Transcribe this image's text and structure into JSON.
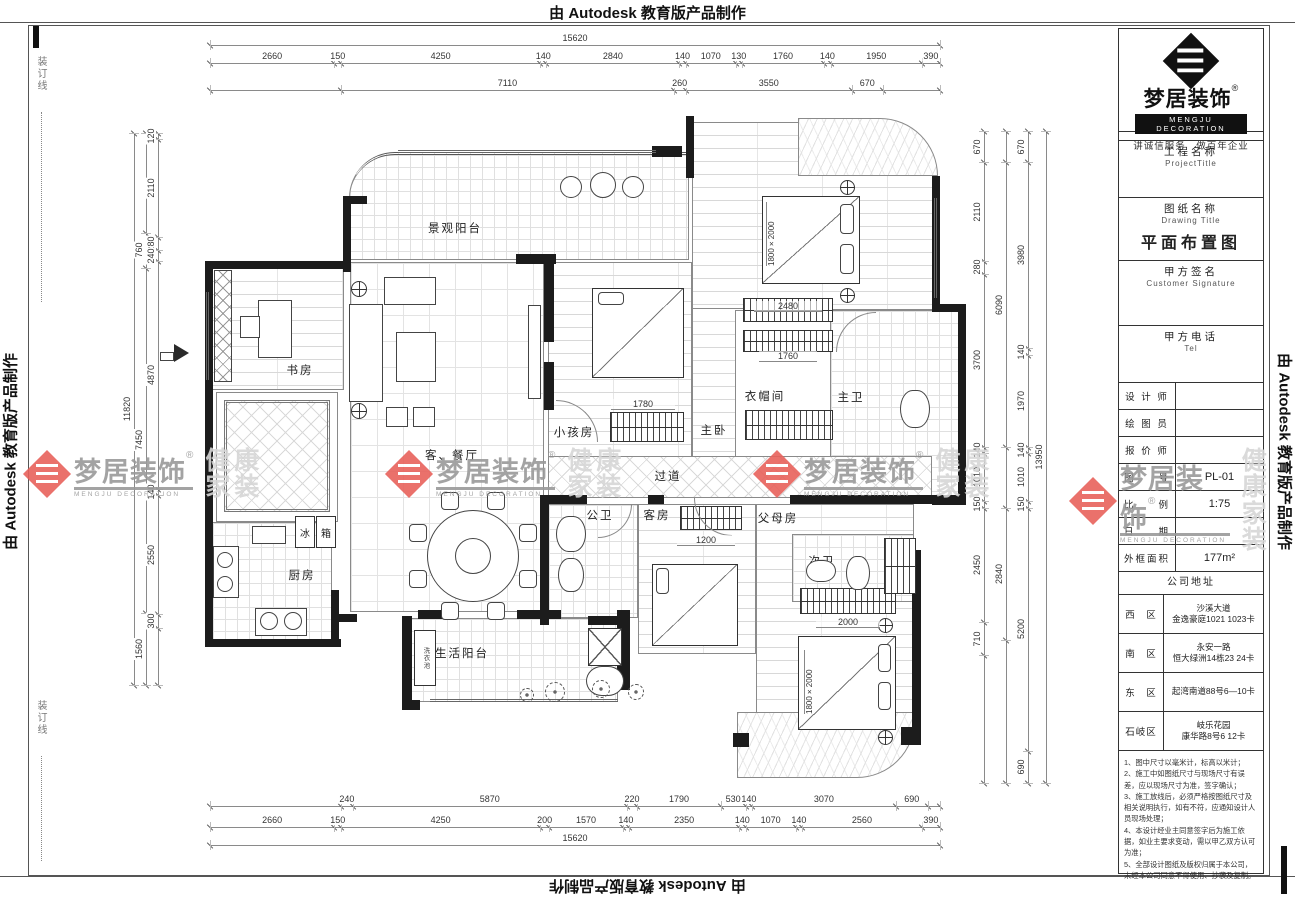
{
  "banners": {
    "top": "由 Autodesk 教育版产品制作",
    "bottom": "由 Autodesk 教育版产品制作",
    "left": "由 Autodesk 教育版产品制作",
    "right": "由 Autodesk 教育版产品制作",
    "binding_line": "装订线"
  },
  "watermark": {
    "brand": "梦居装饰",
    "reg": "®",
    "sub": "MENGJU DECORATION",
    "tag": "健康家装",
    "red": "#e8625c",
    "grey": "#9a9a9a",
    "light": "#d6d6d6"
  },
  "title_block": {
    "logo": {
      "brand": "梦居装饰",
      "reg": "®",
      "sub": "MENGJU DECORATION",
      "slogan": "讲诚信服务　做百年企业"
    },
    "fields": [
      {
        "label": "工程名称",
        "sub": "ProjectTitle",
        "value": ""
      },
      {
        "label": "图纸名称",
        "sub": "Drawing Title",
        "value": "平面布置图"
      },
      {
        "label": "甲方签名",
        "sub": "Customer Signature",
        "value": ""
      },
      {
        "label": "甲方电话",
        "sub": "Tel",
        "value": ""
      }
    ],
    "rows": [
      {
        "label": "设 计 师",
        "value": ""
      },
      {
        "label": "绘 图 员",
        "value": ""
      },
      {
        "label": "报 价 师",
        "value": ""
      },
      {
        "label": "图　　号",
        "value": "PL-01"
      },
      {
        "label": "比　　例",
        "value": "1:75"
      },
      {
        "label": "日　　期",
        "value": ""
      },
      {
        "label": "外框面积",
        "value": "177m²"
      }
    ],
    "address_header": "公司地址",
    "addresses": [
      {
        "area": "西　区",
        "lines": [
          "沙溪大道",
          "金逸豪庭1021 1023卡"
        ]
      },
      {
        "area": "南　区",
        "lines": [
          "永安一路",
          "恒大绿洲14栋23 24卡"
        ]
      },
      {
        "area": "东　区",
        "lines": [
          "起湾南道88号6—10卡",
          ""
        ]
      },
      {
        "area": "石岐区",
        "lines": [
          "岐乐花园",
          "康华路8号6 12卡"
        ]
      }
    ],
    "notes": [
      "1、图中尺寸以毫米计，标高以米计；",
      "2、施工中如图纸尺寸与现场尺寸有误差，应以现场尺寸为准，签字确认；",
      "3、施工放线后，必须严格按图纸尺寸及相关说明执行，如有不符，应通知设计人员现场处理；",
      "4、本设计经业主同意签字后为施工依据，如业主要求变动，需以甲乙双方认可为准；",
      "5、全部设计图纸及版权归属于本公司，未经本公司同意不得使用、抄袭及复制。"
    ]
  },
  "plan": {
    "rooms": {
      "balcony_top": "景观阳台",
      "study": "书房",
      "foyer": "入户玄关",
      "living": "客、餐厅",
      "child": "小孩房",
      "master": "主卧",
      "cloak": "衣帽间",
      "mbath": "主卫",
      "corridor": "过道",
      "pbath": "公卫",
      "guest": "客房",
      "parents": "父母房",
      "sbath": "次卫",
      "kitchen": "厨房",
      "ubalc": "生活阳台"
    },
    "appliances": {
      "fridge1": "冰",
      "fridge2": "箱",
      "laundry": "洗衣池"
    },
    "interior": {
      "d2480": "2480",
      "d1780": "1780",
      "d1760": "1760",
      "d1200": "1200",
      "d2000": "2000",
      "bed_top": "1800×2000",
      "bed_bottom": "1800×2000"
    },
    "dims": {
      "top_total": [
        "15620"
      ],
      "top_row": [
        "2660",
        "150",
        "4250",
        "140",
        "2840",
        "140",
        "1070",
        "130",
        "1760",
        "140",
        "1950",
        "390"
      ],
      "top_partial": [
        "7110",
        "260",
        "3550",
        "670"
      ],
      "bottom_partial": [
        "240",
        "5870",
        "220",
        "1790",
        "530",
        "140",
        "3070",
        "690"
      ],
      "bottom_row": [
        "2660",
        "150",
        "4250",
        "200",
        "1570",
        "140",
        "2350",
        "140",
        "1070",
        "140",
        "2560",
        "390"
      ],
      "bottom_total": [
        "15620"
      ],
      "left_inner": [
        "120",
        "2110",
        "280",
        "240",
        "4870",
        "140",
        "2550",
        "300"
      ],
      "left_mid": [
        "760",
        "7450",
        "1560"
      ],
      "left_total": [
        "11820"
      ],
      "right_inner": [
        "670",
        "2110",
        "280",
        "3700",
        "140",
        "1010",
        "150",
        "2450",
        "710"
      ],
      "right_mid": [
        "6090",
        "2840"
      ],
      "right_outer": [
        "670",
        "3980",
        "140",
        "1970",
        "140",
        "1010",
        "150",
        "5200",
        "690"
      ],
      "right_total": [
        "13950"
      ]
    }
  }
}
